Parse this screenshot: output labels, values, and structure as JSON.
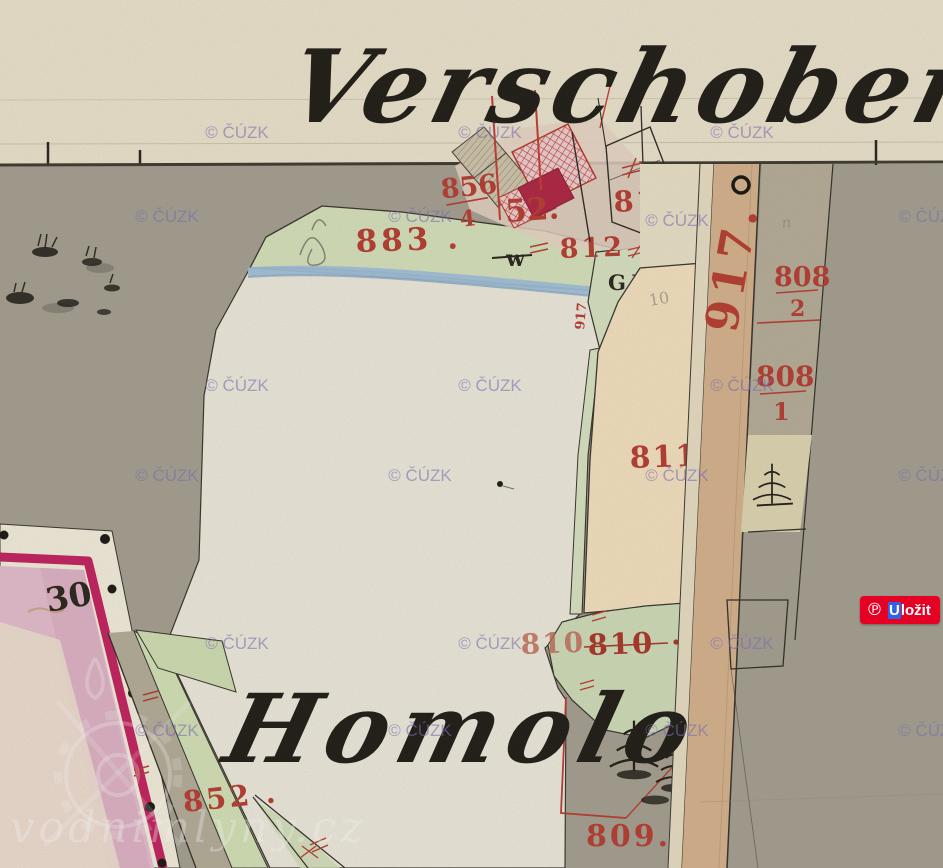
{
  "map": {
    "place_names": {
      "top": "Verschober",
      "bottom": "Homolo"
    },
    "labels": {
      "p856_num": "856",
      "p856_den": "4",
      "p52": "52.",
      "p813": "813.",
      "p812": "812",
      "p883": "883 .",
      "p917_road": "917.",
      "p917_small": "917",
      "p808a_num": "808",
      "p808a_den": "2",
      "p808b_num": "808",
      "p808b_den": "1",
      "p811": "811 .",
      "p810_a": "810",
      "p810_b": "810",
      "p809": "809.",
      "p852": "852 .",
      "p30": "30",
      "gw": "G.W.",
      "w_symbol": "w",
      "pencil_10": "10",
      "pencil_n": "n"
    },
    "watermark": {
      "label": "© ČÚZK",
      "color": "#7d6eb9"
    },
    "site_watermark": {
      "label": "vodnimlyny.cz"
    },
    "colors": {
      "accent_red": "#b5392e",
      "boundary_crimson": "#c21d5c",
      "paper_cream": "#ebe3cd",
      "map_gray": "#a49e90"
    }
  },
  "pinterest": {
    "logo_glyph": "℗",
    "save_first": "U",
    "save_rest": "ložit",
    "color": "#e60023",
    "selection_color": "#2f62e6"
  }
}
